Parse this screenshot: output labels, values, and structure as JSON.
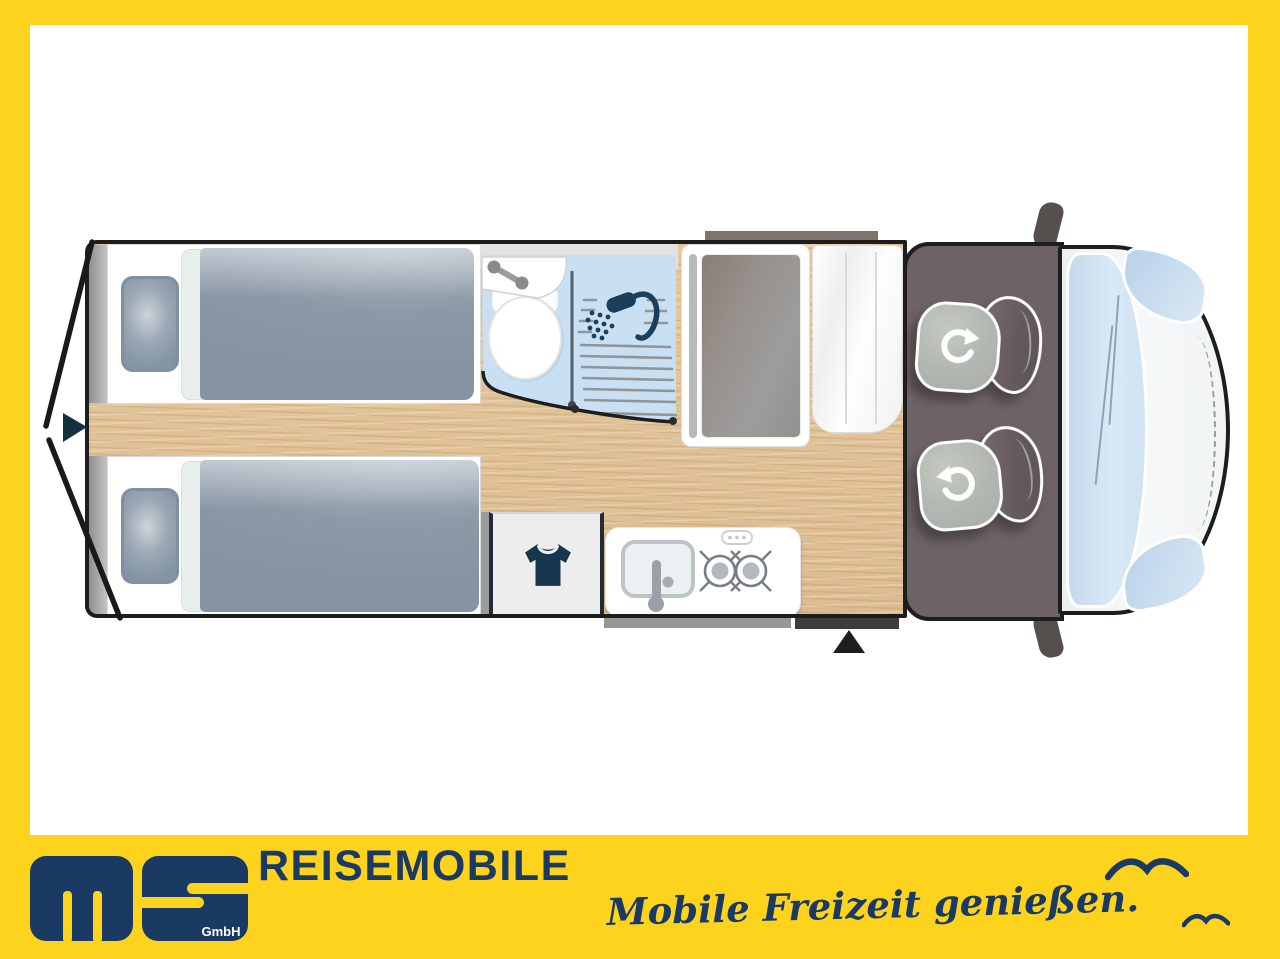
{
  "brand": {
    "monogram": "ms",
    "monogram_subtext": "GmbH",
    "wordmark": "REISEMOBILE",
    "slogan": "Mobile Freizeit genießen.",
    "colors": {
      "brand_yellow": "#fdd31e",
      "brand_navy": "#1b3a63"
    }
  },
  "floorplan": {
    "view": "motorhome-top-view",
    "colors": {
      "outline": "#1d1d1d",
      "wood_floor": "#e3c59c",
      "bathroom_floor": "#c9e0f2",
      "cab_floor": "#6d6266",
      "bedding": "#8d99a7",
      "seat_cushion": "#b2b8b1",
      "seat_backrest": "#675d61",
      "windshield": "#cfe3f2",
      "hood": "#f3f5f6"
    },
    "features": {
      "rear_single_beds": 2,
      "bathroom_icons": [
        "washbasin-icon",
        "toilet-icon",
        "shower-icon"
      ],
      "wardrobe_icon": "tshirt-icon",
      "kitchen_icons": [
        "sink-icon",
        "burner-icon",
        "burner-icon"
      ],
      "cab_swivel_seats": 2,
      "entry_marker": "triangle-up-arrow",
      "rear_marker": "triangle-right-arrow",
      "decor": [
        "seagull-icon",
        "seagull-icon"
      ]
    }
  }
}
